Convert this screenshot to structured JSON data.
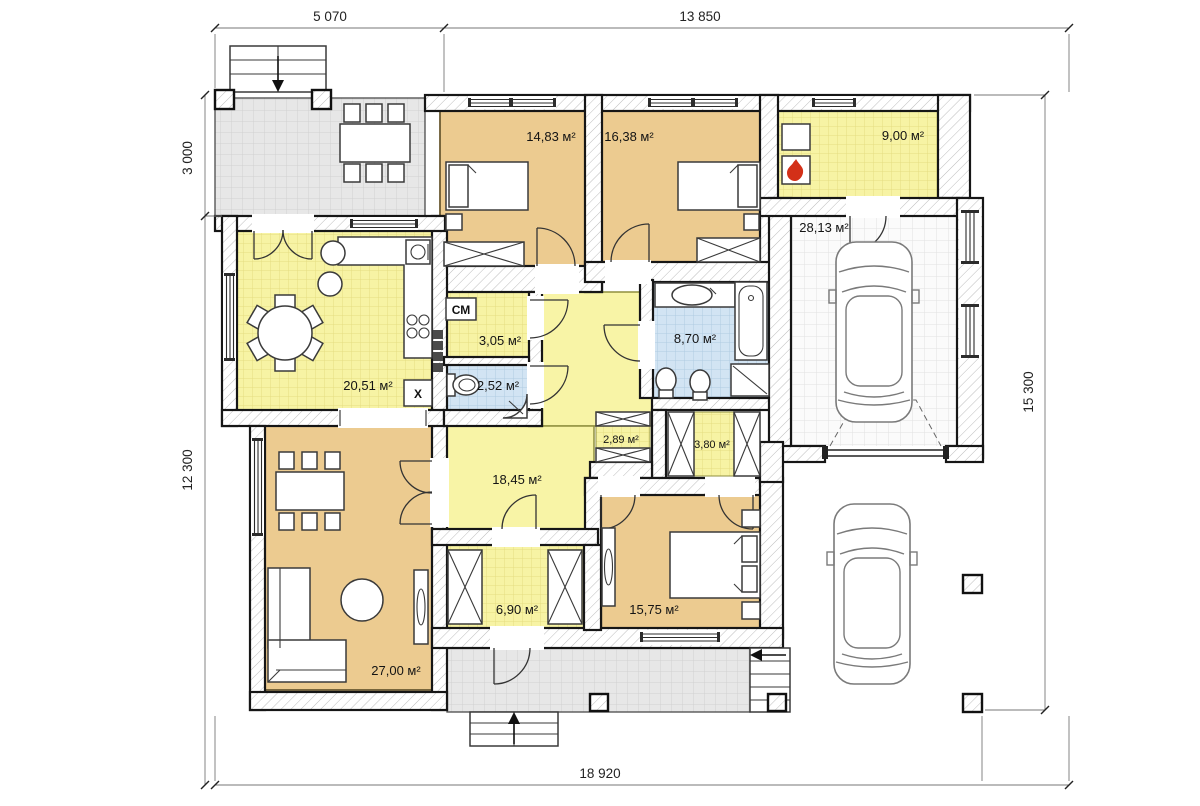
{
  "dimensions": {
    "top_left": "5 070",
    "top_right": "13 850",
    "left_top": "3 000",
    "left_bottom": "12 300",
    "right": "15 300",
    "bottom": "18 920"
  },
  "rooms": [
    {
      "id": "bedroom-1",
      "area": "14,83 м²"
    },
    {
      "id": "bedroom-2",
      "area": "16,38 м²"
    },
    {
      "id": "boiler-room",
      "area": "9,00 м²"
    },
    {
      "id": "garage",
      "area": "28,13 м²"
    },
    {
      "id": "kitchen-dining",
      "area": "20,51 м²"
    },
    {
      "id": "laundry",
      "area": "3,05 м²"
    },
    {
      "id": "wc",
      "area": "2,52 м²"
    },
    {
      "id": "bathroom",
      "area": "8,70 м²"
    },
    {
      "id": "closet-1",
      "area": "2,89 м²"
    },
    {
      "id": "closet-2",
      "area": "3,80 м²"
    },
    {
      "id": "hall",
      "area": "18,45 м²"
    },
    {
      "id": "entry",
      "area": "6,90 м²"
    },
    {
      "id": "living-room",
      "area": "27,00 м²"
    },
    {
      "id": "bedroom-3",
      "area": "15,75 м²"
    }
  ],
  "markers": {
    "washing_machine": "СМ",
    "fridge": "Х"
  },
  "colors": {
    "room_tan": "#eccb90",
    "room_yellow": "#f7f3a4",
    "room_blue": "#d2e4f3",
    "terrace_gray": "#e7e7e7",
    "flame_red": "#d33018"
  }
}
